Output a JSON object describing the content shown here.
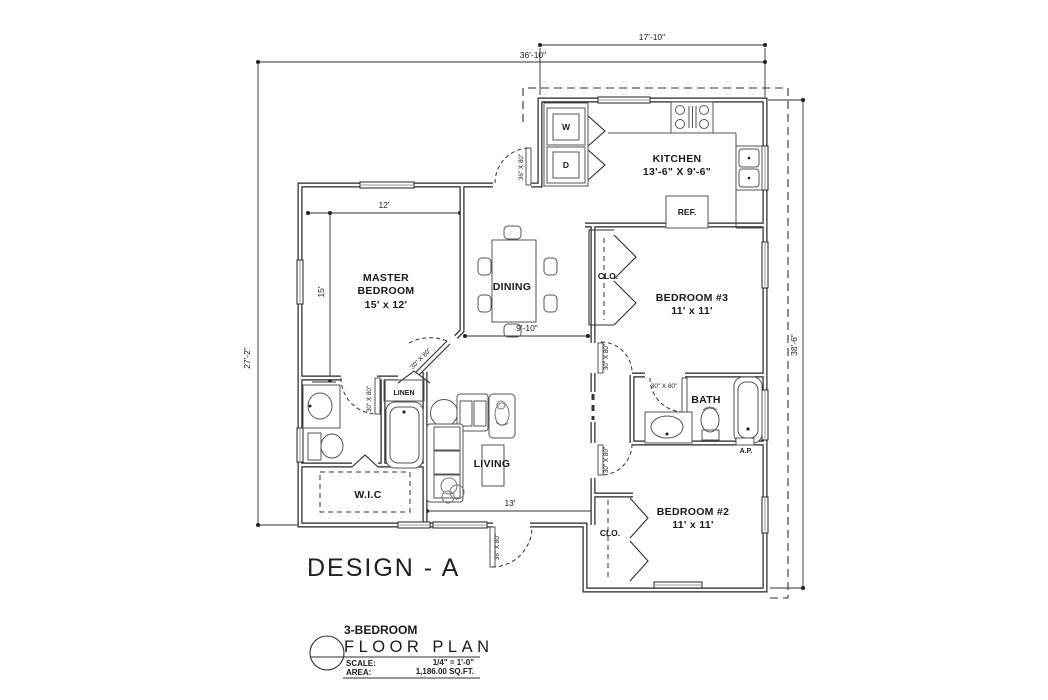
{
  "drawing": {
    "design_title": "DESIGN - A"
  },
  "title_block": {
    "subtitle": "3-BEDROOM",
    "title": "FLOOR PLAN",
    "scale_label": "SCALE:",
    "scale_value": "1/4\" = 1'-0\"",
    "area_label": "AREA:",
    "area_value": "1,186.00 SQ.FT."
  },
  "rooms": {
    "kitchen_name": "KITCHEN",
    "kitchen_size": "13'-6\" X 9'-6\"",
    "master_line1": "MASTER",
    "master_line2": "BEDROOM",
    "master_size": "15' x 12'",
    "dining_name": "DINING",
    "living_name": "LIVING",
    "bedroom3_name": "BEDROOM #3",
    "bedroom3_size": "11' x 11'",
    "bedroom2_name": "BEDROOM #2",
    "bedroom2_size": "11' x 11'",
    "bath_name": "BATH",
    "wic_name": "W.I.C",
    "linen_name": "LINEN",
    "closet_bedroom3": "CLO.",
    "closet_bedroom2": "CLO.",
    "fridge": "REF.",
    "washer": "W",
    "dryer": "D",
    "access_panel": "A.P."
  },
  "dimensions": {
    "top_kitchen": "17'-10\"",
    "top_overall": "36'-10\"",
    "left_overall": "27'-2\"",
    "right_overall": "38'-6\"",
    "master_width": "12'",
    "master_depth": "15'",
    "dining_width": "9'-10\"",
    "living_width": "13'"
  },
  "doors": {
    "back_door": "36\" X 80\"",
    "front_door": "36\" X 80\"",
    "master_door": "30\" X 80\"",
    "master_bath_door": "30\" X 80\"",
    "bedroom3_door": "30\" X 80\"",
    "bath_door": "30\" X 80\"",
    "bedroom2_door": "30\" X 80\""
  }
}
